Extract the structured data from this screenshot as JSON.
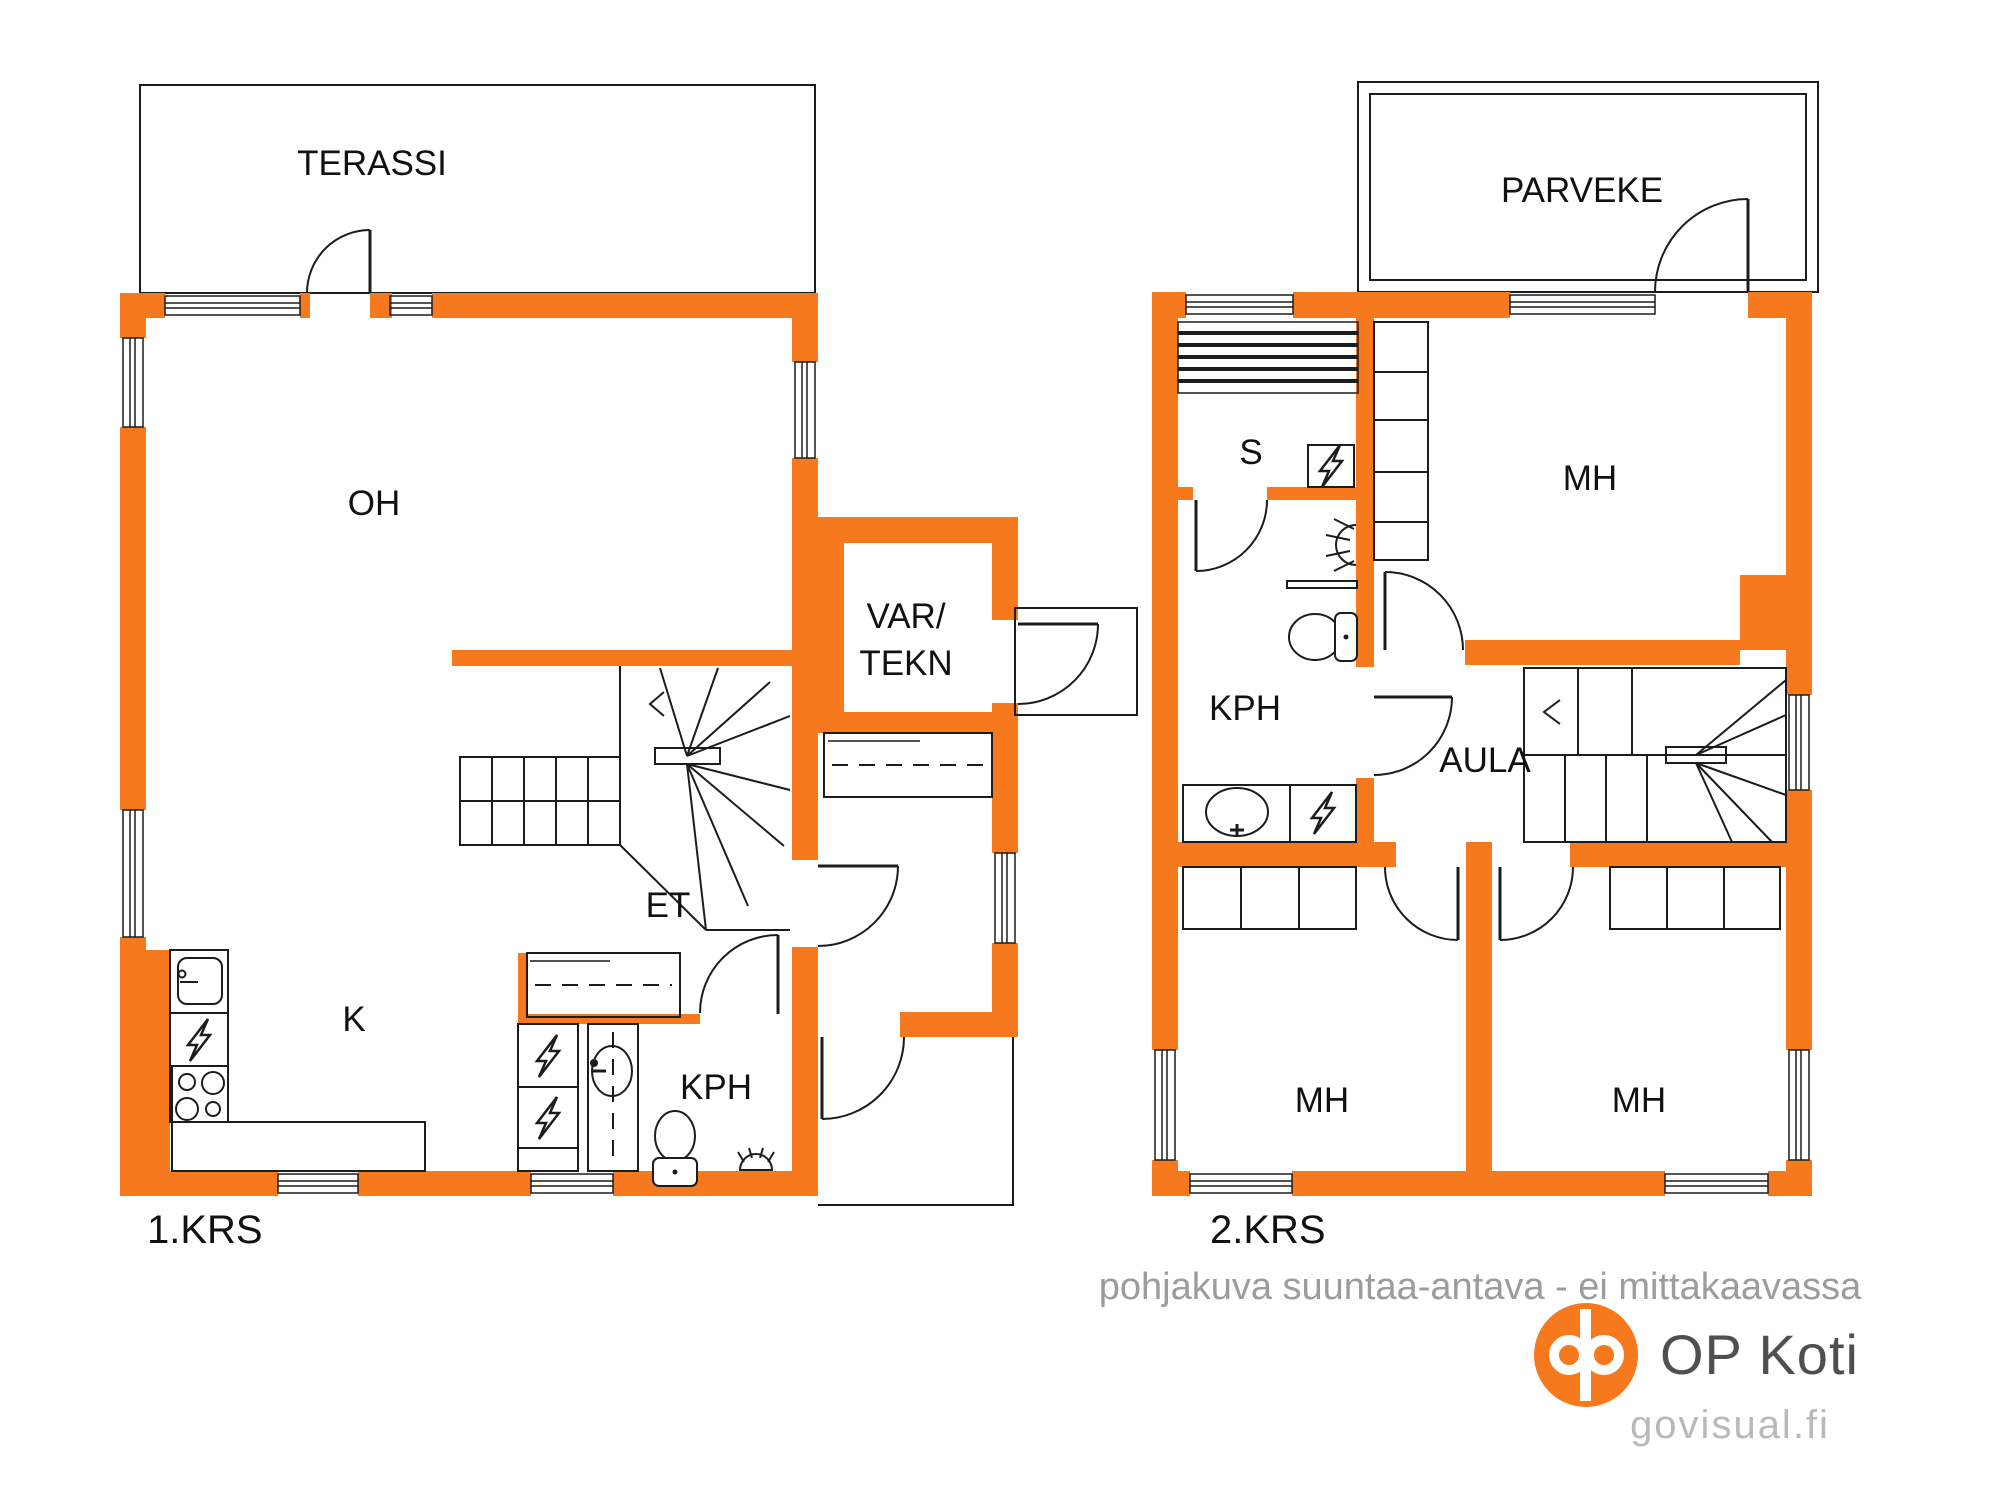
{
  "meta": {
    "width": 2000,
    "height": 1500,
    "type": "real-estate floor plan, two storeys"
  },
  "colors": {
    "wall_orange": "#f7791e",
    "line_black": "#1c1c1c",
    "label_black": "#111111",
    "disclaimer_gray": "#9c9c9c",
    "brand_gray": "#4f4f4f",
    "site_gray": "#b9b9b9",
    "logo_orange": "#f7791e",
    "background": "#ffffff"
  },
  "floor1": {
    "label": "1.KRS",
    "rooms": {
      "terassi": "TERASSI",
      "oh": "OH",
      "var_tekn_line1": "VAR/",
      "var_tekn_line2": "TEKN",
      "et": "ET",
      "k": "K",
      "kph": "KPH"
    }
  },
  "floor2": {
    "label": "2.KRS",
    "rooms": {
      "parveke": "PARVEKE",
      "s": "S",
      "mh_top": "MH",
      "kph": "KPH",
      "aula": "AULA",
      "mh_left": "MH",
      "mh_right": "MH"
    }
  },
  "footer": {
    "disclaimer": "pohjakuva suuntaa-antava - ei mittakaavassa",
    "brand": "OP Koti",
    "site": "govisual.fi"
  },
  "icons": {
    "appliance": "lightning-bolt-icon",
    "sauna_stove": "lightning-bolt-icon",
    "shower": "shower-spray-icon",
    "floor_drain": "floor-drain-icon",
    "toilet": "toilet-icon",
    "kitchen_sink": "sink-icon",
    "bathroom_sink": "sink-icon",
    "stove_top": "four-burner-hob-icon",
    "stairs": "winder-stairs-icon",
    "wardrobe": "wardrobe-icon",
    "sauna_bench": "sauna-bench-icon",
    "direction_arrow": "chevron-left-icon"
  }
}
